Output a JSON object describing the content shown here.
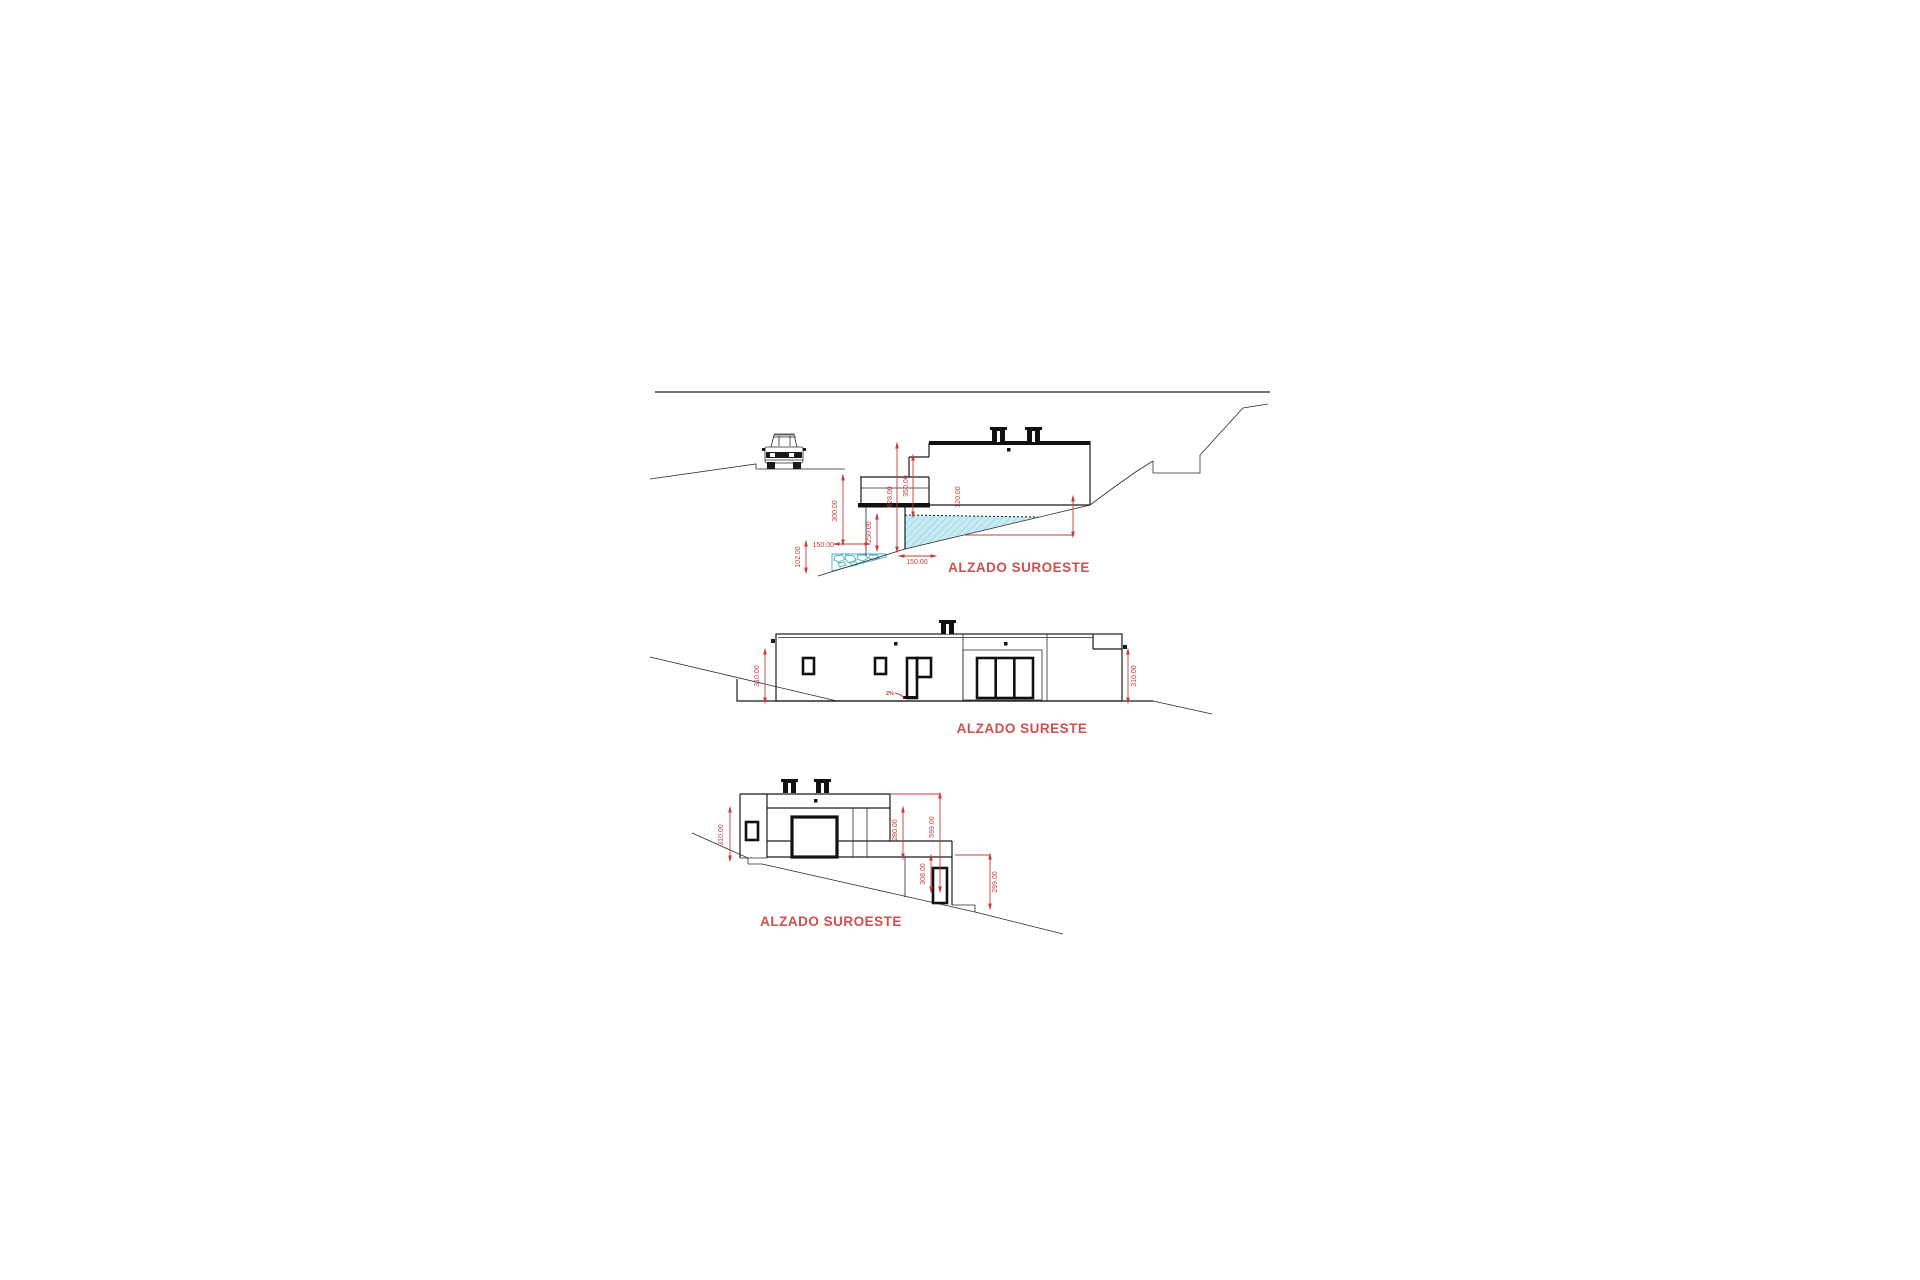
{
  "colors": {
    "line_black": "#1b1b1b",
    "dimension_red": "#c43c3c",
    "title_red": "#cf4f4f",
    "pool_fill": "#c8ebf3",
    "pool_hatch": "#8fd4e2",
    "pool_stroke": "#2e9fb0",
    "background": "#ffffff"
  },
  "drawing": {
    "top_elevation": {
      "title": "ALZADO SUROESTE",
      "dims": {
        "v628": "628.00",
        "v350": "350.00",
        "v120": "120.00",
        "v300": "300.00",
        "v250": "250.00",
        "w150_pool": "150.00",
        "v102": "102.00",
        "w150_wall": "150.00"
      }
    },
    "middle_elevation": {
      "title": "ALZADO SURESTE",
      "dims": {
        "left": "310.00",
        "right": "310.00"
      },
      "slope_note": "2%"
    },
    "bottom_elevation": {
      "title": "ALZADO SUROESTE",
      "dims": {
        "left": "310.00",
        "v280": "280.00",
        "v599": "599.00",
        "v308": "308.00",
        "v299": "299.00"
      }
    }
  }
}
